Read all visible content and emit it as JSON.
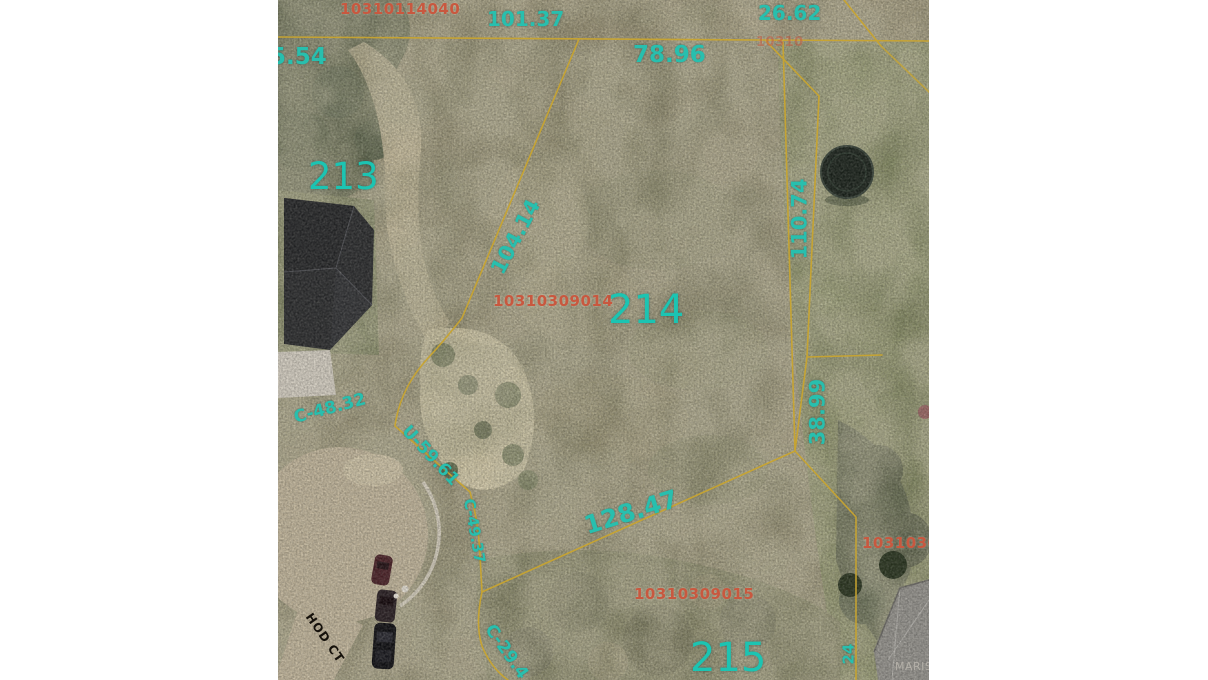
{
  "map": {
    "labels": {
      "id_top": "10310114040",
      "dim_101": "101.37",
      "dim_26": "26.62",
      "dim_5": "5.54",
      "parcel_213": "213",
      "dim_78": "78.96",
      "dim_104": "104.14",
      "dim_110": "110.74",
      "id_214": "10310309014",
      "parcel_214": "214",
      "dim_c48": "C-48.32",
      "dim_u59": "U-59.61",
      "dim_38": "38.99",
      "dim_128": "128.47",
      "dim_c49": "C-49.37",
      "id_215": "10310309015",
      "parcel_215": "215",
      "id_right": "103103090",
      "id_topright_fragment": "10310",
      "dim_c29": "C-29.4",
      "dim_right_fragment": "24",
      "street": "HOD CT",
      "watermark": "MARIS"
    },
    "colors": {
      "dim": "#28bfae",
      "pnum": "#1cc4b2",
      "pid": "#c8583f",
      "boundary": "#c9a530",
      "street": "#15110b",
      "watermark": "#b4b0a8"
    }
  }
}
